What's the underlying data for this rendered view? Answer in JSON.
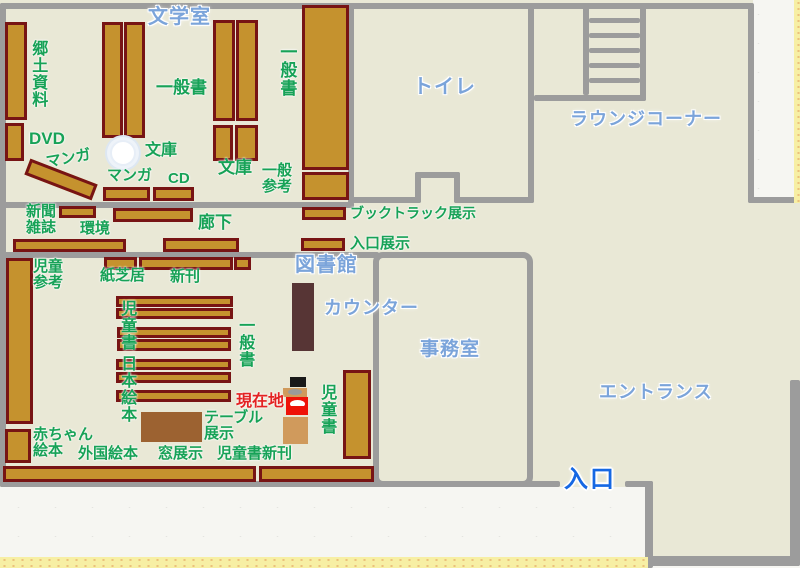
{
  "map": {
    "rooms": {
      "literature_room": "文学室",
      "toilet": "トイレ",
      "lounge_corner": "ラウンジコーナー",
      "library": "図書館",
      "counter": "カウンター",
      "office": "事務室",
      "entrance_hall": "エントランス",
      "entrance_door": "入口"
    },
    "areas": {
      "kyodo_shiryo": "郷土資料",
      "dvd": "DVD",
      "manga_tilted": "マンガ",
      "manga": "マンガ",
      "cd": "CD",
      "ippansho_literature": "一般書",
      "bunko_circle": "文庫",
      "bunko": "文庫",
      "ippansho_wall": "一般書",
      "ippan_sanko": "一般\n参考",
      "booktruck_tenji": "ブックトラック展示",
      "iriguchi_tenji": "入口展示",
      "shinbun_zasshi": "新聞\n雑誌",
      "kankyo": "環境",
      "roka": "廊下",
      "jido_sanko": "児童\n参考",
      "jidosho_left": "児童書",
      "nihon_ehon": "日本絵本",
      "kamishibai": "紙芝居",
      "shinkan": "新刊",
      "ippansho_children": "一般書",
      "jidosho_right": "児童書",
      "table_tenji": "テーブル\n展示",
      "akachan_ehon": "赤ちゃん\n絵本",
      "gaikoku_ehon": "外国絵本",
      "mado_tenji": "窓展示",
      "jidosho_shinkan": "児童書新刊",
      "genzaichi": "現在地"
    },
    "colors": {
      "floor": "#e9e8d6",
      "wall": "#9c9c9c",
      "shelf_fill": "#c5922e",
      "shelf_border": "#771414",
      "counter": "#573535",
      "table": "#9c6231",
      "marker_red": "#ee1208",
      "marker_tan": "#d09a5c",
      "green_label": "#17a257",
      "blue_label": "#7ba4da",
      "entrance_blue": "#1668e3",
      "current_red": "#e32222",
      "paper": "#f6f6f2",
      "border_yellow": "#f7efa4"
    }
  }
}
